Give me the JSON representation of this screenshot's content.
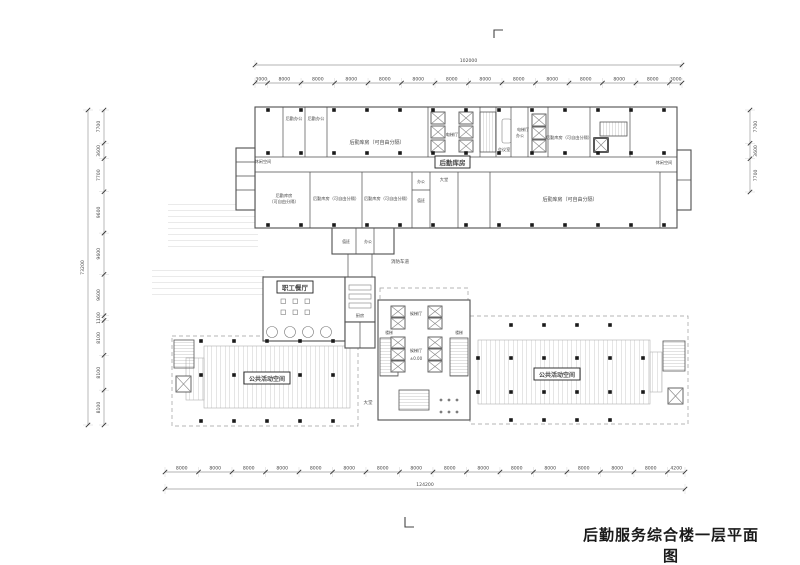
{
  "title": "后勤服务综合楼一层平面图",
  "dimensions": {
    "top": {
      "total": "102000",
      "segments": [
        "3000",
        "8000",
        "8000",
        "8000",
        "8000",
        "8000",
        "8000",
        "8000",
        "8000",
        "8000",
        "8000",
        "8000",
        "8000",
        "3000"
      ]
    },
    "bottom": {
      "total": "124200",
      "segments": [
        "8000",
        "8000",
        "8000",
        "8000",
        "8000",
        "8000",
        "8000",
        "8000",
        "8000",
        "8000",
        "8000",
        "8000",
        "8000",
        "8000",
        "8000",
        "4200"
      ]
    },
    "left": {
      "total": "73200",
      "segments": [
        "7700",
        "3600",
        "7700",
        "9600",
        "9600",
        "9600",
        "1100",
        "8100",
        "8100",
        "8100"
      ]
    },
    "right": {
      "segments": [
        "7700",
        "3600",
        "7700"
      ]
    }
  },
  "labels": {
    "upper": {
      "leisure_left": "休闲空间",
      "leisure_right": "休闲空间",
      "office1": "后勤办公",
      "office2": "后勤办公",
      "storage_big": "后勤库房（可自由分隔）",
      "storage_top_right": "后勤库房（可自由分隔）",
      "storage_line1": "后勤库房",
      "storage_line2": "（可自由分隔）",
      "storage_b2": "后勤库房（可自由分隔）",
      "storage_b3": "后勤库房（可自由分隔）",
      "storage_right": "后勤库房（可自由分隔）",
      "elevator_hall1": "电梯厅",
      "elevator_hall2": "电梯厅",
      "meeting": "会议室",
      "office_small": "办公",
      "office_b2": "办公",
      "duty_b2": "值班",
      "lobby_small": "大堂",
      "annex_duty": "值班",
      "annex_office": "办公",
      "storage_tag": "后勤库房"
    },
    "lower": {
      "canteen": "职工餐厅",
      "kitchen": "厨房",
      "waiting_hall1": "候梯厅",
      "waiting_hall2": "候梯厅",
      "stair_left": "楼梯",
      "stair_right": "楼梯",
      "level": "±0.00",
      "lobby": "大堂",
      "public_left": "公共活动空间",
      "public_right": "公共活动空间",
      "fire_lane": "消防车道"
    }
  }
}
